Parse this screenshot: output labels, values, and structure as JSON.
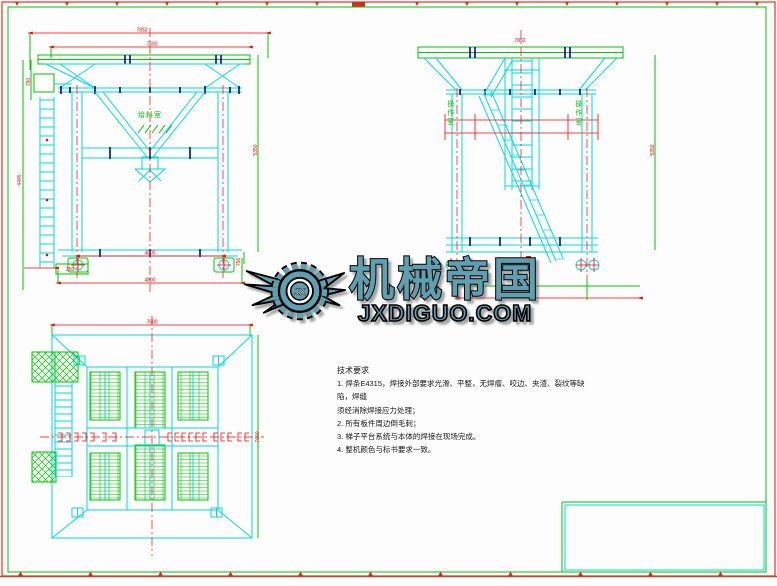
{
  "watermark": {
    "brand": "机械帝国",
    "domain": "JXDIGUO.COM",
    "monogram": "JX",
    "color": "#5e9fb0"
  },
  "tech": {
    "title": "技术要求",
    "items": [
      "1. 焊条E4315，焊接外部要求光滑、平整，无焊瘤、咬边、夹渣、裂纹等缺陷，焊缝",
      "须经消除焊接应力处理；",
      "2. 所有板件周边倒毛刺；",
      "3. 梯子平台系统与本体的焊接在现场完成。",
      "4. 整机颜色与标书要求一致。"
    ]
  },
  "views": {
    "front": {
      "room_label": "给料室",
      "dims": {
        "top": "7852",
        "top_inner": "7600",
        "left": "4445",
        "left_upper": "750",
        "right": "5350",
        "bottom_inner": "4000",
        "bottom_outer": "4800",
        "base_left": "250",
        "base_right": "750"
      }
    },
    "side": {
      "room_label_left": "操作室",
      "room_label_right": "操作室",
      "dims": {
        "top": "7852",
        "right": "5350"
      }
    },
    "plan": {
      "dims": {
        "top": "7600",
        "right": "7600"
      }
    }
  },
  "colors": {
    "cyan": "#00dcdc",
    "green": "#00c800",
    "red": "#ff0000",
    "blue": "#0008a8",
    "brown": "#b14a32",
    "teal": "#5e9fb0"
  }
}
